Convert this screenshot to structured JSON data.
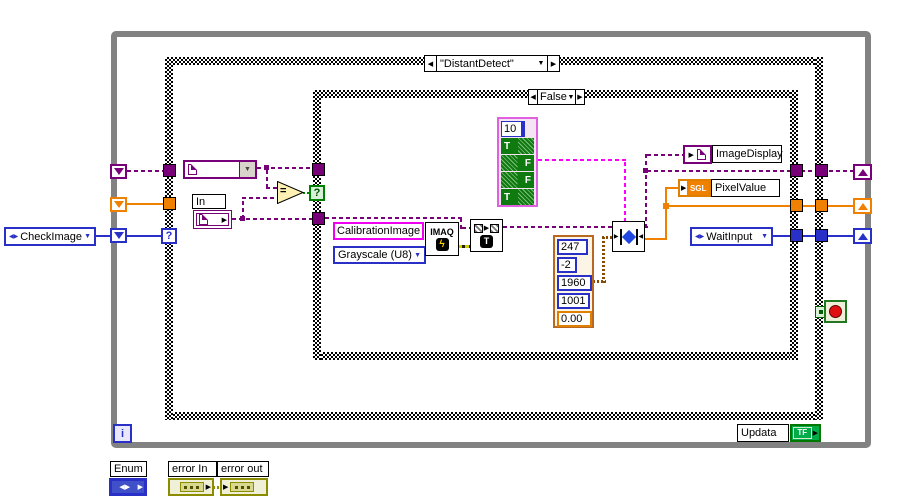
{
  "outer_case": {
    "selector": "\"DistantDetect\"",
    "selector_terminal": "?"
  },
  "inner_case": {
    "selector": "False",
    "selector_terminal": "?"
  },
  "glyphs": {
    "prev": "◀",
    "next": "▶",
    "down": "▼",
    "updown": "◀▶",
    "arrow": "▶",
    "lightning": "ϟ",
    "readfile_t": "T",
    "equals": "="
  },
  "labels": {
    "check_image": "CheckImage",
    "in": "In",
    "calibration_image": "CalibrationImage",
    "grayscale": "Grayscale (U8)",
    "imaq": "IMAQ",
    "image_display": "ImageDisplay",
    "pixel_value": "PixelValue",
    "sgl": "SGL",
    "wait_input": "WaitInput",
    "updata": "Updata",
    "tf": "TF",
    "iteration": "i",
    "enum": "Enum",
    "error_in": "error In",
    "error_out": "error out"
  },
  "bool_array": {
    "index": "10",
    "values": [
      "T",
      "F",
      "F",
      "T"
    ]
  },
  "number_cluster": {
    "values": [
      "247",
      "-2",
      "1960",
      "1001",
      "0.00"
    ]
  },
  "colors": {
    "image_wire_purple": "#780078",
    "string_magenta": "#F000F0",
    "array_pink": "#FF00FF",
    "numeric_orange": "#F08000",
    "enum_blue": "#2830C8",
    "boolean_green": "#008000",
    "bool_cell_green": "#0F7A0F",
    "error_olive": "#8C8C00",
    "cluster_brown": "#8A4A00",
    "loop_gray": "#828282",
    "stop_red": "#E01010"
  }
}
